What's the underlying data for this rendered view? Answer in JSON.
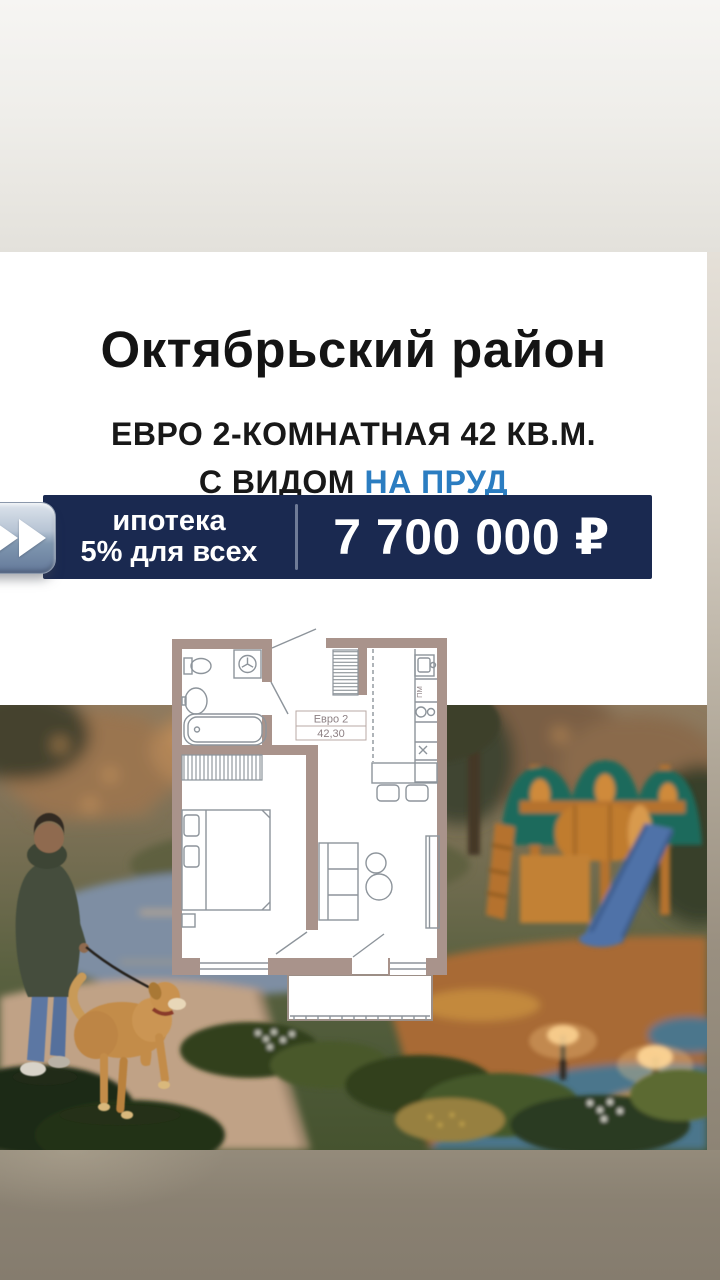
{
  "story": {
    "title": "Октябрьский район",
    "subtitle_line1": "ЕВРО 2-КОМНАТНАЯ 42 КВ.М.",
    "subtitle_prefix": "С ВИДОМ",
    "subtitle_accent": "НА ПРУД",
    "banner": {
      "offer_line1": "ипотека",
      "offer_line2": "5% для всех",
      "price": "7 700 000 ₽"
    },
    "floorplan": {
      "type_label": "Евро 2",
      "area_label": "42,30",
      "dishwasher_label": "ПМ"
    },
    "icons": {
      "fast_forward": "fast-forward-icon"
    },
    "colors": {
      "accent_blue": "#2b7dc1",
      "banner_navy": "#1a2950",
      "wall_taupe": "#a9938b",
      "photo_dusk": "#8e7a5f"
    }
  }
}
